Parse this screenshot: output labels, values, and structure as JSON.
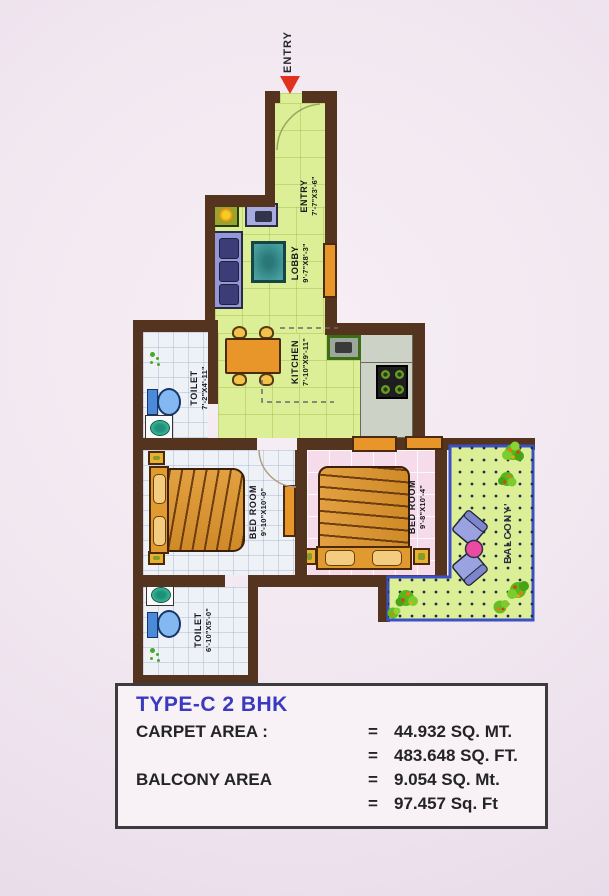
{
  "plan": {
    "entry_marker": "ENTRY",
    "rooms": [
      {
        "id": "entry",
        "name": "ENTRY",
        "dims": "7'-7\"X3'-6\""
      },
      {
        "id": "lobby",
        "name": "LOBBY",
        "dims": "9'-7\"X8'-3\""
      },
      {
        "id": "kitchen",
        "name": "KITCHEN",
        "dims": "7'-10\"X9'-11\""
      },
      {
        "id": "toilet-1",
        "name": "TOILET",
        "dims": "7'-2\"X4'-11\""
      },
      {
        "id": "bedroom-1",
        "name": "BED ROOM",
        "dims": "9'-10\"X10'-0\""
      },
      {
        "id": "bedroom-2",
        "name": "BED ROOM",
        "dims": "9'-8\"X10'-4\""
      },
      {
        "id": "toilet-2",
        "name": "TOILET",
        "dims": "6'-10\"X5'-0\""
      },
      {
        "id": "balcony",
        "name": "BALCONY'",
        "dims": ""
      }
    ]
  },
  "info_box": {
    "title": "TYPE-C 2 BHK",
    "rows": [
      {
        "label": "CARPET AREA :",
        "lines": [
          {
            "eq": "=",
            "val": "44.932 SQ. MT."
          },
          {
            "eq": "=",
            "val": "483.648 SQ. FT."
          }
        ]
      },
      {
        "label": "BALCONY AREA",
        "lines": [
          {
            "eq": "=",
            "val": "9.054 SQ. Mt."
          },
          {
            "eq": "=",
            "val": "97.457 Sq. Ft"
          }
        ]
      }
    ]
  },
  "colors": {
    "wall": "#55341f",
    "floor_green": "#dcee96",
    "floor_pink": "#f6dcea",
    "floor_tile": "#eef1f6",
    "balcony_border": "#3a50c4",
    "title_blue": "#3a3ac0",
    "arrow_red": "#e23020"
  }
}
